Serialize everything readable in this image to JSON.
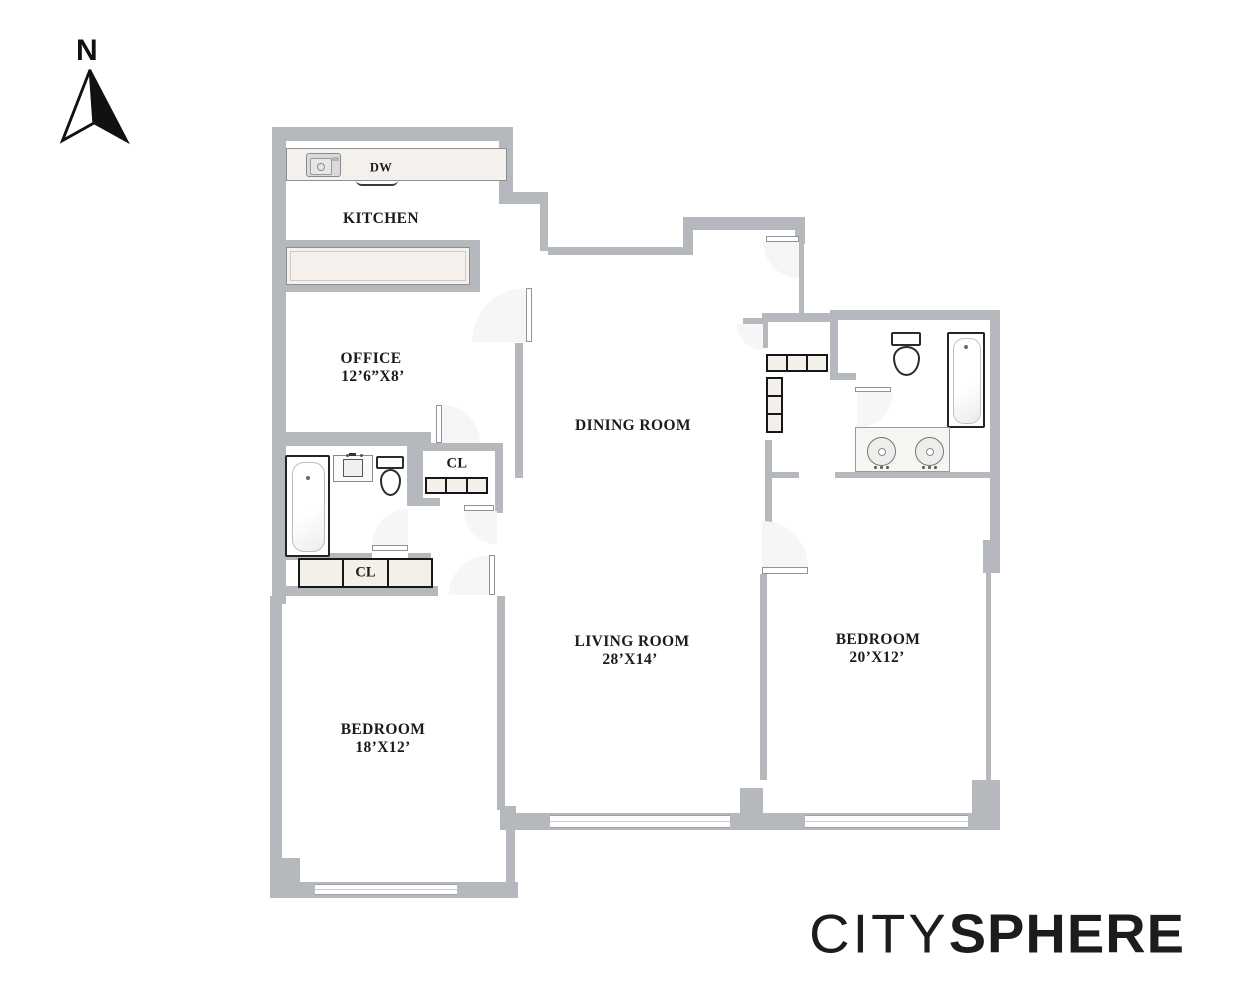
{
  "compass": {
    "n": "N"
  },
  "labels": {
    "kitchen": "KITCHEN",
    "dw": "DW",
    "office": "OFFICE",
    "office_dims": "12’6”X8’",
    "dining": "DINING ROOM",
    "cl": "CL",
    "living": "LIVING ROOM",
    "living_dims": "28’X14’",
    "bedroom": "BEDROOM",
    "bedroom_left_dims": "18’X12’",
    "bedroom_right_dims": "20’X12’"
  },
  "brand": {
    "part1": "CITY",
    "part2": "SPHERE"
  },
  "icons": [
    "north-arrow-icon",
    "kitchen-sink-icon",
    "dishwasher-icon",
    "bathtub-icon",
    "toilet-icon",
    "vanity-sink-icon",
    "double-vanity-icon",
    "closet-shelves-icon",
    "door-swing-icon",
    "window-icon"
  ],
  "colors": {
    "wall": "#b5b8bd",
    "counter": "#f4f1ec",
    "shelf": "#f3f0ea",
    "arc": "#f6f6f6",
    "text": "#1b1b1b",
    "fixture_border": "#2a2a2a"
  }
}
